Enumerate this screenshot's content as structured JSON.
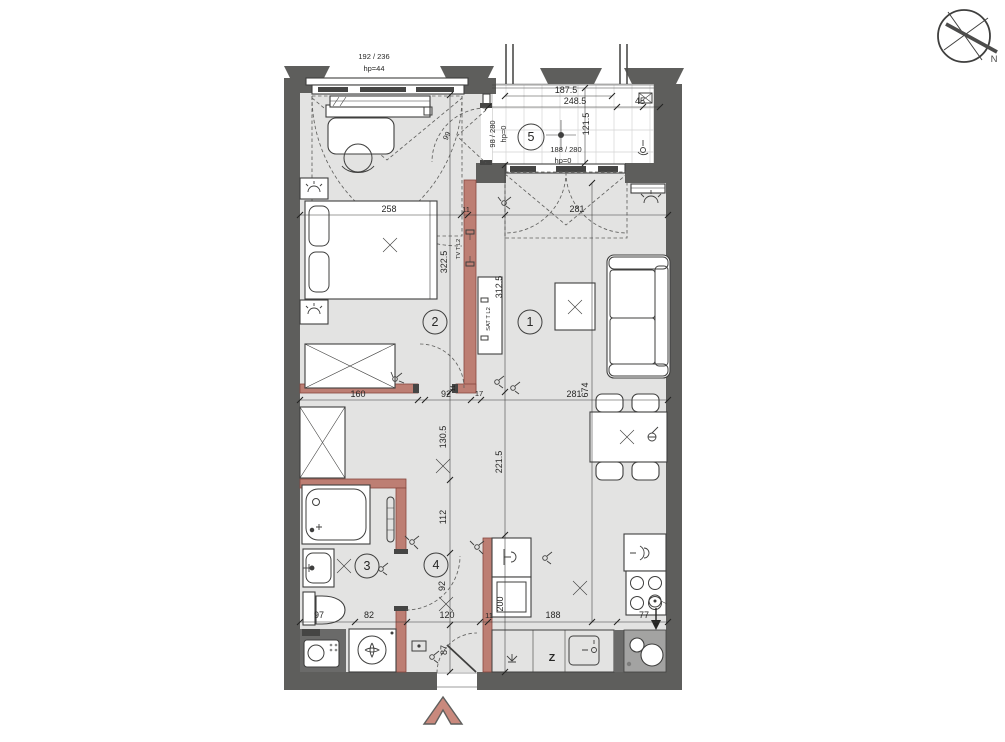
{
  "colors": {
    "floor": "#e3e3e2",
    "wall": "#5e5e5c",
    "accent_wall": "#bd7e73",
    "balcony_floor": "#ffffff",
    "line": "#3f3f3e",
    "entrance_arrow": "#c9897d"
  },
  "compass": {
    "label": "N"
  },
  "rooms": {
    "living": "1",
    "bedroom": "2",
    "bathroom": "3",
    "hall": "4",
    "balcony": "5"
  },
  "windows": {
    "bedroom_size": "192 / 236",
    "bedroom_sill": "hp=44",
    "balcony_door_size": "98 / 280",
    "balcony_door_sill": "hp=0",
    "living_window_size": "188 / 280",
    "living_window_sill": "hp=0"
  },
  "outlets": {
    "tv": "TV T L2",
    "sat": "SAT T L2"
  },
  "kitchen": {
    "freezer": "Z"
  },
  "dims": {
    "balcony_inner": "187.5",
    "balcony_outer": "248.5",
    "balcony_depth": "121.5",
    "balcony_side": "45",
    "door_swing": "99",
    "bed_wall": "258",
    "wall_top": "11",
    "living_top": "281",
    "bedroom_depth": "322.5",
    "living_depth": "312.5",
    "living_length": "674",
    "wardrobe_wall": "160",
    "hall_width": "92",
    "wall_mid": "17",
    "living_width": "281",
    "wall_stub": "11",
    "hall_seg1": "130.5",
    "hall_seg2": "112",
    "hall_seg3": "92",
    "entry_seg": "87",
    "living_lower": "221.5",
    "kitchen_depth": "200",
    "shaft_width": "97",
    "bath_width": "82",
    "entry_width": "120",
    "wall_bottom": "11",
    "kitchen_width": "188",
    "stove_width": "77"
  }
}
